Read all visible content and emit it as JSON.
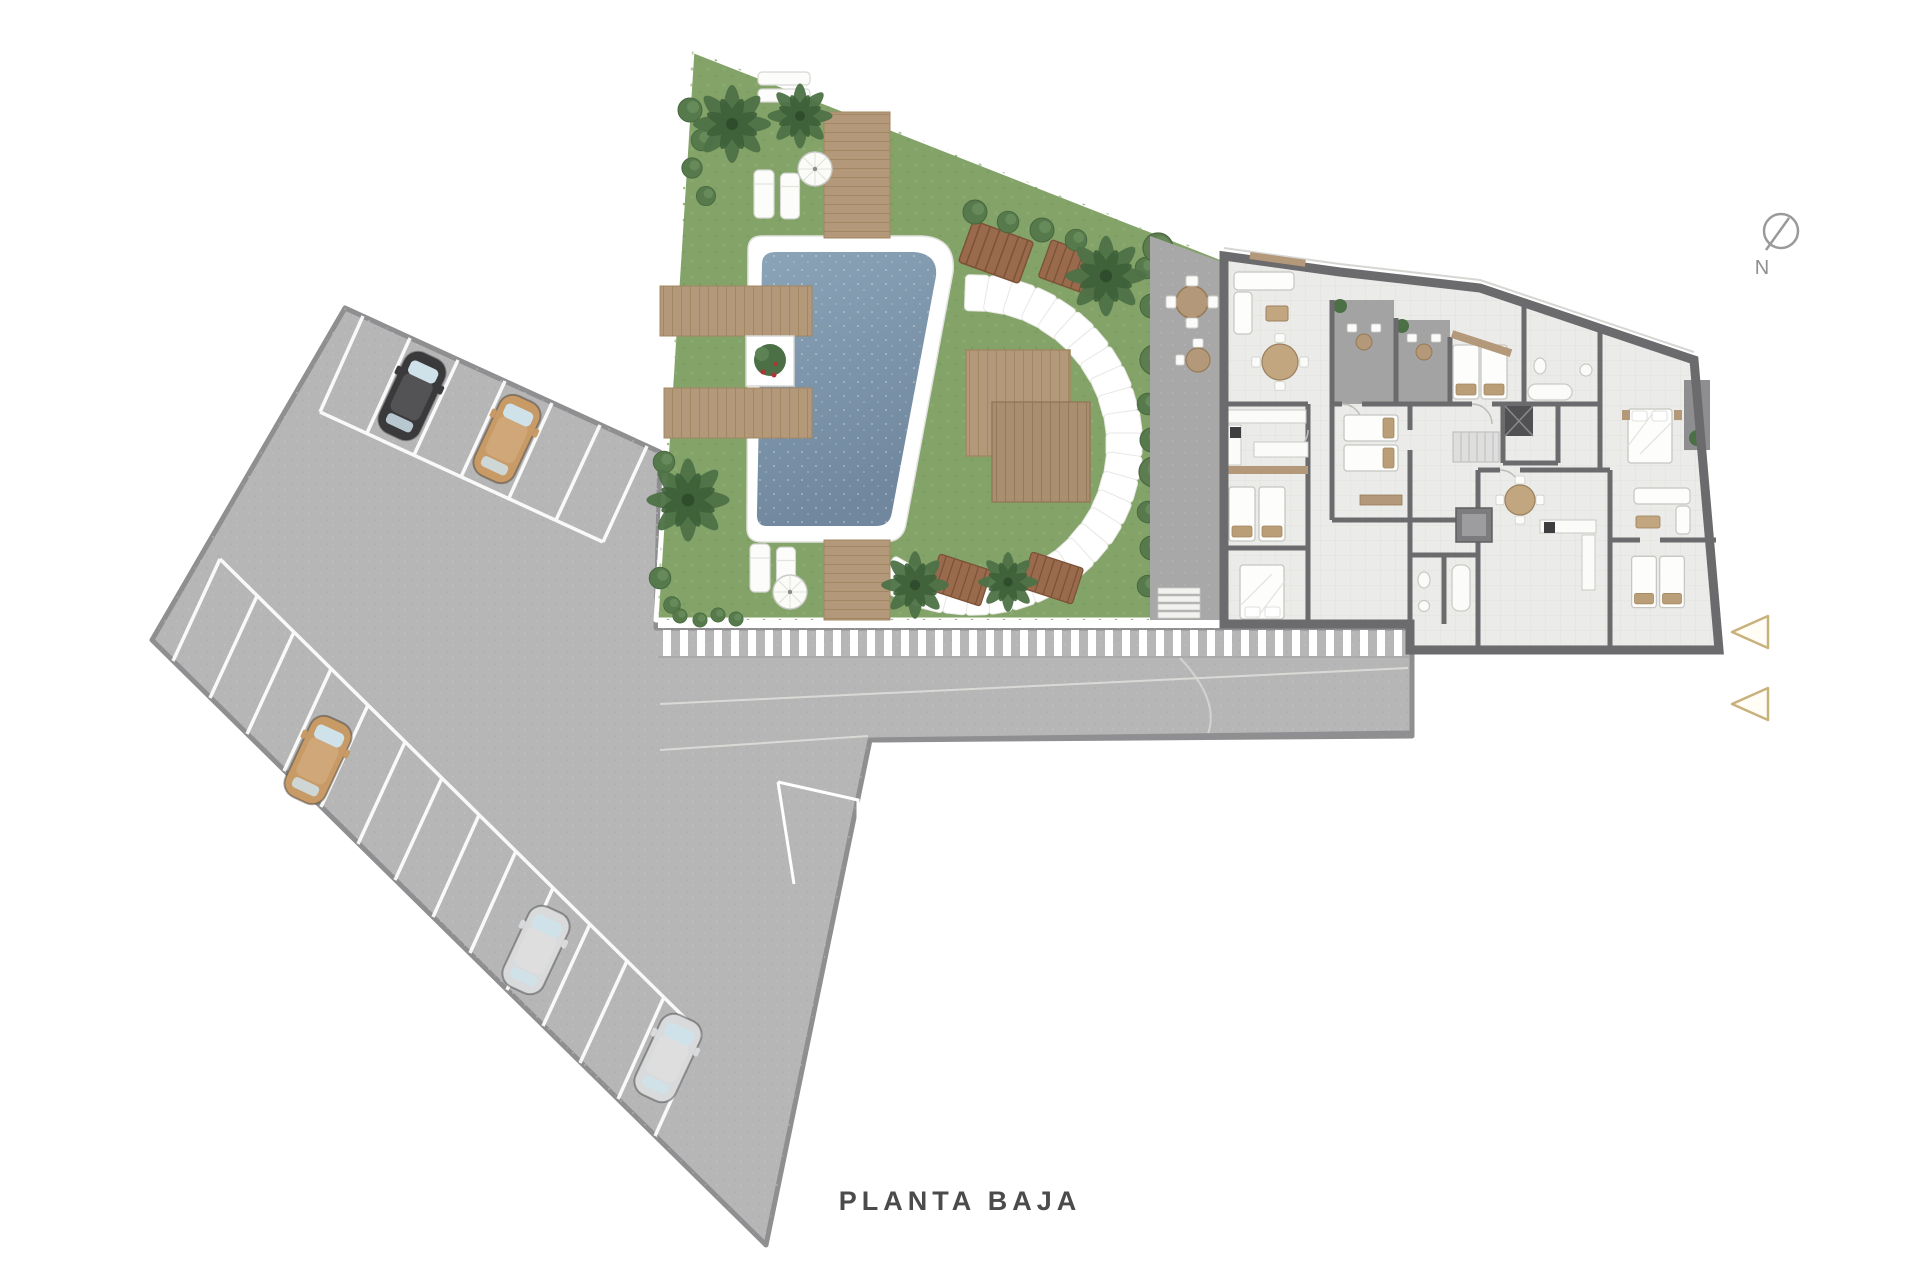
{
  "title": {
    "text": "PLANTA BAJA"
  },
  "compass": {
    "label": "N"
  },
  "palette": {
    "background": "#ffffff",
    "asphalt": "#b6b6b7",
    "asphalt_border": "#8f8f91",
    "grass": "#83a369",
    "pool_water": "#7e98ae",
    "deck_wood": "#b3987a",
    "bench_wood": "#9a6a4c",
    "building_floor": "#ebebe9",
    "wall": "#6b6b6e",
    "terrace": "#a8a8a8",
    "stone_white": "#ffffff",
    "arrow_gold": "#c9b17c",
    "hedge_green": "#4c7046",
    "title_text": "#4b4b4b"
  },
  "site": {
    "floor_label": "PLANTA BAJA",
    "areas": [
      "parking-lot",
      "garden",
      "pool",
      "apartment-building",
      "access-road"
    ],
    "parking": {
      "cars": [
        {
          "color": "black"
        },
        {
          "color": "tan"
        },
        {
          "color": "tan"
        },
        {
          "color": "silver"
        },
        {
          "color": "silver"
        }
      ]
    },
    "garden": {
      "umbrellas": 2,
      "sun_loungers": 6,
      "wood_benches": 4,
      "stepping_stones": 27,
      "palm_trees": 6
    },
    "entry_arrows": 2
  }
}
